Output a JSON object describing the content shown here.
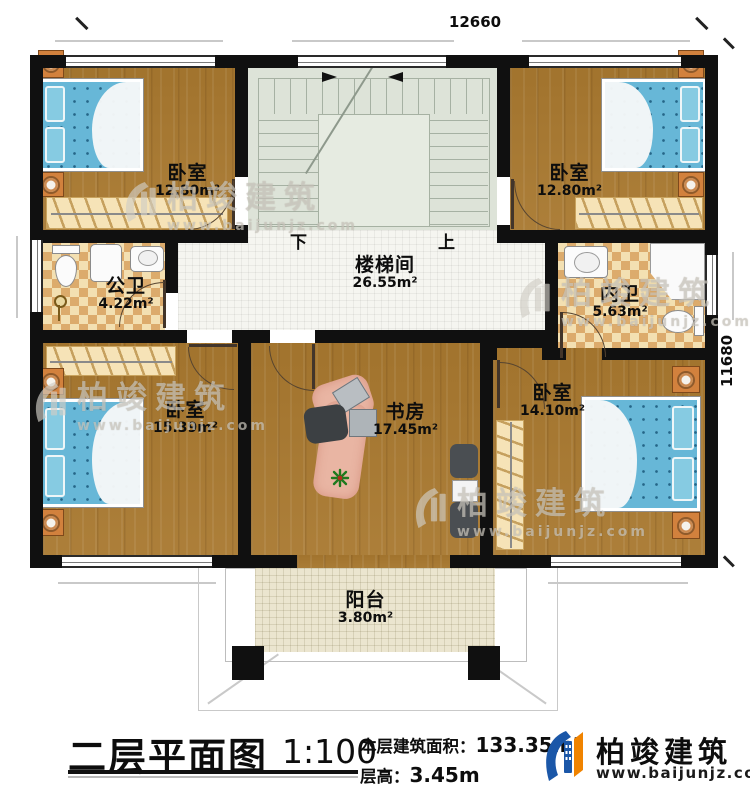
{
  "dimensions": {
    "top": "12660",
    "right": "11680"
  },
  "stairwell": {
    "down_label": "下",
    "up_label": "上"
  },
  "rooms": {
    "bedroom_tl": {
      "name": "卧室",
      "area": "12.80m²"
    },
    "bedroom_tr": {
      "name": "卧室",
      "area": "12.80m²"
    },
    "public_bath": {
      "name": "公卫",
      "area": "4.22m²"
    },
    "ensuite_bath": {
      "name": "内卫",
      "area": "5.63m²"
    },
    "stair_hall": {
      "name": "楼梯间",
      "area": "26.55m²"
    },
    "bedroom_bl": {
      "name": "卧室",
      "area": "15.39m²"
    },
    "study": {
      "name": "书房",
      "area": "17.45m²"
    },
    "bedroom_br": {
      "name": "卧室",
      "area": "14.10m²"
    },
    "balcony": {
      "name": "阳台",
      "area": "3.80m²"
    }
  },
  "watermark": {
    "brand": "柏竣建筑",
    "url": "www.baijunjz.com"
  },
  "legend": {
    "title": "二层平面图",
    "scale": "1:100",
    "floor_area_label": "本层建筑面积：",
    "floor_area_value": "133.35m²",
    "floor_height_label": "层高：",
    "floor_height_value": "3.45m"
  },
  "brand": {
    "name": "柏竣建筑",
    "url": "www.baijunjz.com"
  },
  "colors": {
    "wall": "#101010",
    "wood": "#a8782f",
    "bath_tile": "#dcab6c",
    "stairs": "#dde3d8",
    "bed_blue": "#67b7d7",
    "accent_blue": "#1b57a8",
    "accent_orange": "#f08300"
  }
}
